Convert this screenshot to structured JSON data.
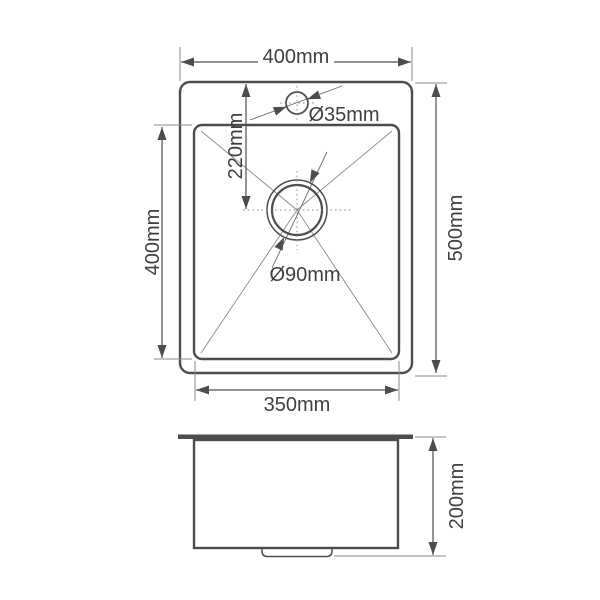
{
  "colors": {
    "line": "#4d4d4d",
    "thin": "#8a8a8a",
    "text": "#3f3f3f",
    "bg": "#ffffff"
  },
  "top_view": {
    "overall_width": "400mm",
    "overall_depth": "500mm",
    "faucet_center_offset": "220mm",
    "bowl_length": "400mm",
    "bowl_width": "350mm",
    "faucet_hole_diameter": "Ø35mm",
    "drain_diameter": "Ø90mm"
  },
  "side_view": {
    "bowl_height": "200mm"
  }
}
